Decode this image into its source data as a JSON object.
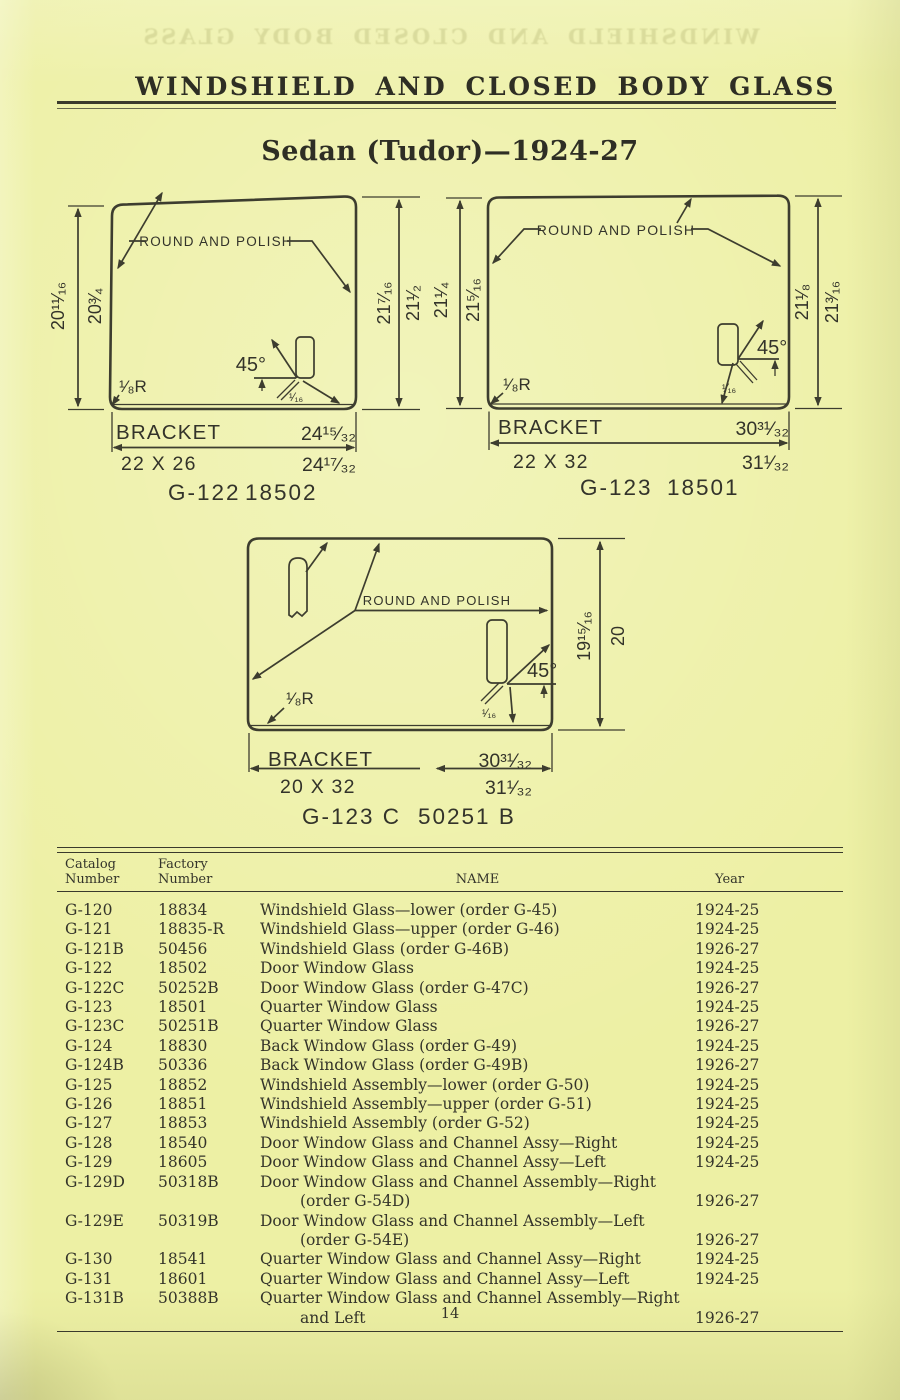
{
  "page": {
    "header_title": "WINDSHIELD AND CLOSED BODY GLASS",
    "ghost_text": "WINDSHIELD AND CLOSED BODY GLASS",
    "subtitle": "Sedan (Tudor)—1924-27",
    "page_number": "14"
  },
  "colors": {
    "paper": "#edf0a4",
    "ink": "#34342a",
    "line": "#3d3d2f"
  },
  "diagrams": [
    {
      "caption_catalog": "G-122",
      "caption_factory": "18502",
      "round_polish": "ROUND AND POLISH",
      "bracket": "BRACKET",
      "size": "22 X 26",
      "bracket_width": "24¹⁵⁄₃₂",
      "glass_width": "24¹⁷⁄₃₂",
      "dim_left_outer": "20¹¹⁄₁₆",
      "dim_left_inner": "20³⁄₄",
      "dim_right_inner": "21⁷⁄₁₆",
      "dim_right_outer": "21¹⁄₂",
      "radius": "¹⁄₈R",
      "angle": "45°",
      "edge": "¹⁄₁₆"
    },
    {
      "caption_catalog": "G-123",
      "caption_factory": "18501",
      "round_polish": "ROUND AND POLISH",
      "bracket": "BRACKET",
      "size": "22 X 32",
      "bracket_width": "30³¹⁄₃₂",
      "glass_width": "31¹⁄₃₂",
      "dim_left_outer": "21¹⁄₄",
      "dim_left_inner": "21⁵⁄₁₆",
      "dim_right_inner": "21¹⁄₈",
      "dim_right_outer": "21³⁄₁₆",
      "radius": "¹⁄₈R",
      "angle": "45°",
      "edge": "¹⁄₁₆"
    },
    {
      "caption_catalog": "G-123 C",
      "caption_factory": "50251 B",
      "round_polish": "ROUND AND POLISH",
      "bracket": "BRACKET",
      "size": "20 X 32",
      "bracket_width": "30³¹⁄₃₂",
      "glass_width": "31¹⁄₃₂",
      "dim_right_inner": "19¹⁵⁄₁₆",
      "dim_right_outer": "20",
      "radius": "¹⁄₈R",
      "angle": "45°",
      "edge": "¹⁄₁₆"
    }
  ],
  "table": {
    "headers": {
      "catalog": [
        "Catalog",
        "Number"
      ],
      "factory": [
        "Factory",
        "Number"
      ],
      "name": "NAME",
      "year": "Year"
    },
    "rows": [
      {
        "catalog": "G-120",
        "factory": "18834",
        "name_lines": [
          "Windshield Glass—lower (order G-45)"
        ],
        "year": "1924-25",
        "year_line": 1
      },
      {
        "catalog": "G-121",
        "factory": "18835-R",
        "name_lines": [
          "Windshield Glass—upper (order G-46)"
        ],
        "year": "1924-25",
        "year_line": 1
      },
      {
        "catalog": "G-121B",
        "factory": "50456",
        "name_lines": [
          "Windshield Glass (order G-46B)"
        ],
        "year": "1926-27",
        "year_line": 1
      },
      {
        "catalog": "G-122",
        "factory": "18502",
        "name_lines": [
          "Door Window Glass"
        ],
        "year": "1924-25",
        "year_line": 1
      },
      {
        "catalog": "G-122C",
        "factory": "50252B",
        "name_lines": [
          "Door Window Glass (order G-47C)"
        ],
        "year": "1926-27",
        "year_line": 1
      },
      {
        "catalog": "G-123",
        "factory": "18501",
        "name_lines": [
          "Quarter Window Glass"
        ],
        "year": "1924-25",
        "year_line": 1
      },
      {
        "catalog": "G-123C",
        "factory": "50251B",
        "name_lines": [
          "Quarter Window Glass"
        ],
        "year": "1926-27",
        "year_line": 1
      },
      {
        "catalog": "G-124",
        "factory": "18830",
        "name_lines": [
          "Back Window Glass (order G-49)"
        ],
        "year": "1924-25",
        "year_line": 1
      },
      {
        "catalog": "G-124B",
        "factory": "50336",
        "name_lines": [
          "Back Window Glass (order G-49B)"
        ],
        "year": "1926-27",
        "year_line": 1
      },
      {
        "catalog": "G-125",
        "factory": "18852",
        "name_lines": [
          "Windshield Assembly—lower (order G-50)"
        ],
        "year": "1924-25",
        "year_line": 1
      },
      {
        "catalog": "G-126",
        "factory": "18851",
        "name_lines": [
          "Windshield Assembly—upper (order G-51)"
        ],
        "year": "1924-25",
        "year_line": 1
      },
      {
        "catalog": "G-127",
        "factory": "18853",
        "name_lines": [
          "Windshield Assembly (order G-52)"
        ],
        "year": "1924-25",
        "year_line": 1
      },
      {
        "catalog": "G-128",
        "factory": "18540",
        "name_lines": [
          "Door Window Glass and Channel Assy—Right"
        ],
        "year": "1924-25",
        "year_line": 1
      },
      {
        "catalog": "G-129",
        "factory": "18605",
        "name_lines": [
          "Door Window Glass and Channel Assy—Left"
        ],
        "year": "1924-25",
        "year_line": 1
      },
      {
        "catalog": "G-129D",
        "factory": "50318B",
        "name_lines": [
          "Door Window Glass and Channel Assembly—Right",
          "(order G-54D)"
        ],
        "year": "1926-27",
        "year_line": 2
      },
      {
        "catalog": "G-129E",
        "factory": "50319B",
        "name_lines": [
          "Door Window Glass and Channel Assembly—Left",
          "(order G-54E)"
        ],
        "year": "1926-27",
        "year_line": 2
      },
      {
        "catalog": "G-130",
        "factory": "18541",
        "name_lines": [
          "Quarter Window Glass and Channel Assy—Right"
        ],
        "year": "1924-25",
        "year_line": 1
      },
      {
        "catalog": "G-131",
        "factory": "18601",
        "name_lines": [
          "Quarter Window Glass and Channel Assy—Left"
        ],
        "year": "1924-25",
        "year_line": 1
      },
      {
        "catalog": "G-131B",
        "factory": "50388B",
        "name_lines": [
          "Quarter Window Glass and Channel Assembly—Right",
          "and Left"
        ],
        "year": "1926-27",
        "year_line": 2
      }
    ]
  }
}
